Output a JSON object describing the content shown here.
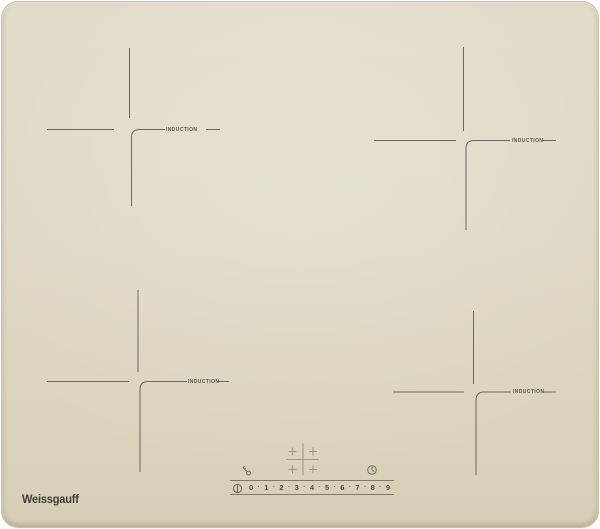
{
  "brand": {
    "logo_text": "Weissgauff"
  },
  "surface": {
    "glass_color": "#ded8c4",
    "marking_color": "#6b675c",
    "label_color": "#57544a",
    "selector_color": "#9d9788"
  },
  "zones": [
    {
      "position": "top-left",
      "label": "INDUCTION"
    },
    {
      "position": "top-right",
      "label": "INDUCTION"
    },
    {
      "position": "bottom-left",
      "label": "INDUCTION"
    },
    {
      "position": "bottom-right",
      "label": "INDUCTION"
    }
  ],
  "control_panel": {
    "child_lock_icon": "key-icon",
    "timer_icon": "clock-icon",
    "zone_selector_icon": "four-zone-plus-grid-icon",
    "power_icon": "standby-power-icon",
    "separator": "·",
    "power_levels": [
      "0",
      "1",
      "2",
      "3",
      "4",
      "5",
      "6",
      "7",
      "8",
      "9"
    ]
  }
}
